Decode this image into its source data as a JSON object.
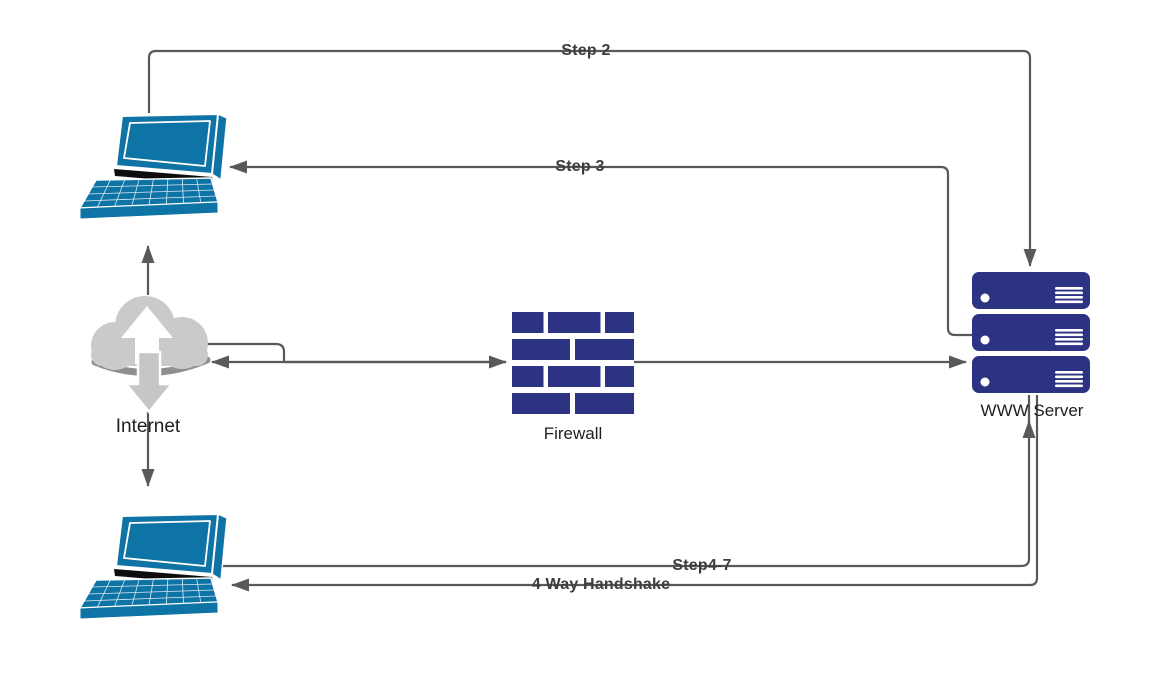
{
  "diagram": {
    "type": "network-flow-diagram",
    "colors": {
      "node_navy": "#2d3383",
      "laptop_blue": "#0e73a5",
      "connector_gray": "#595959",
      "cloud_gray": "#cacaca",
      "edge_label_color": "#3d3d3d"
    },
    "nodes": {
      "client_top": {
        "label": "",
        "icon": "laptop-icon"
      },
      "internet": {
        "label": "Internet",
        "icon": "cloud-up-down-icon"
      },
      "firewall": {
        "label": "Firewall",
        "icon": "brick-wall-icon"
      },
      "www_server": {
        "label": "WWW Server",
        "icon": "server-stack-icon"
      },
      "client_bottom": {
        "label": "",
        "icon": "laptop-icon"
      }
    },
    "edges": [
      {
        "label": "Step 2",
        "from": "client_top",
        "to": "www_server"
      },
      {
        "label": "Step 3",
        "from": "www_server",
        "to": "client_top"
      },
      {
        "label": "",
        "from": "internet",
        "to": "client_top"
      },
      {
        "label": "",
        "from": "internet",
        "to": "client_bottom"
      },
      {
        "label": "",
        "from": "internet",
        "to": "firewall",
        "bidirectional": true
      },
      {
        "label": "",
        "from": "firewall",
        "to": "www_server"
      },
      {
        "label": "Step4-7",
        "from": "client_bottom",
        "to": "www_server"
      },
      {
        "label": "4 Way Handshake",
        "from": "www_server",
        "to": "client_bottom"
      }
    ]
  }
}
